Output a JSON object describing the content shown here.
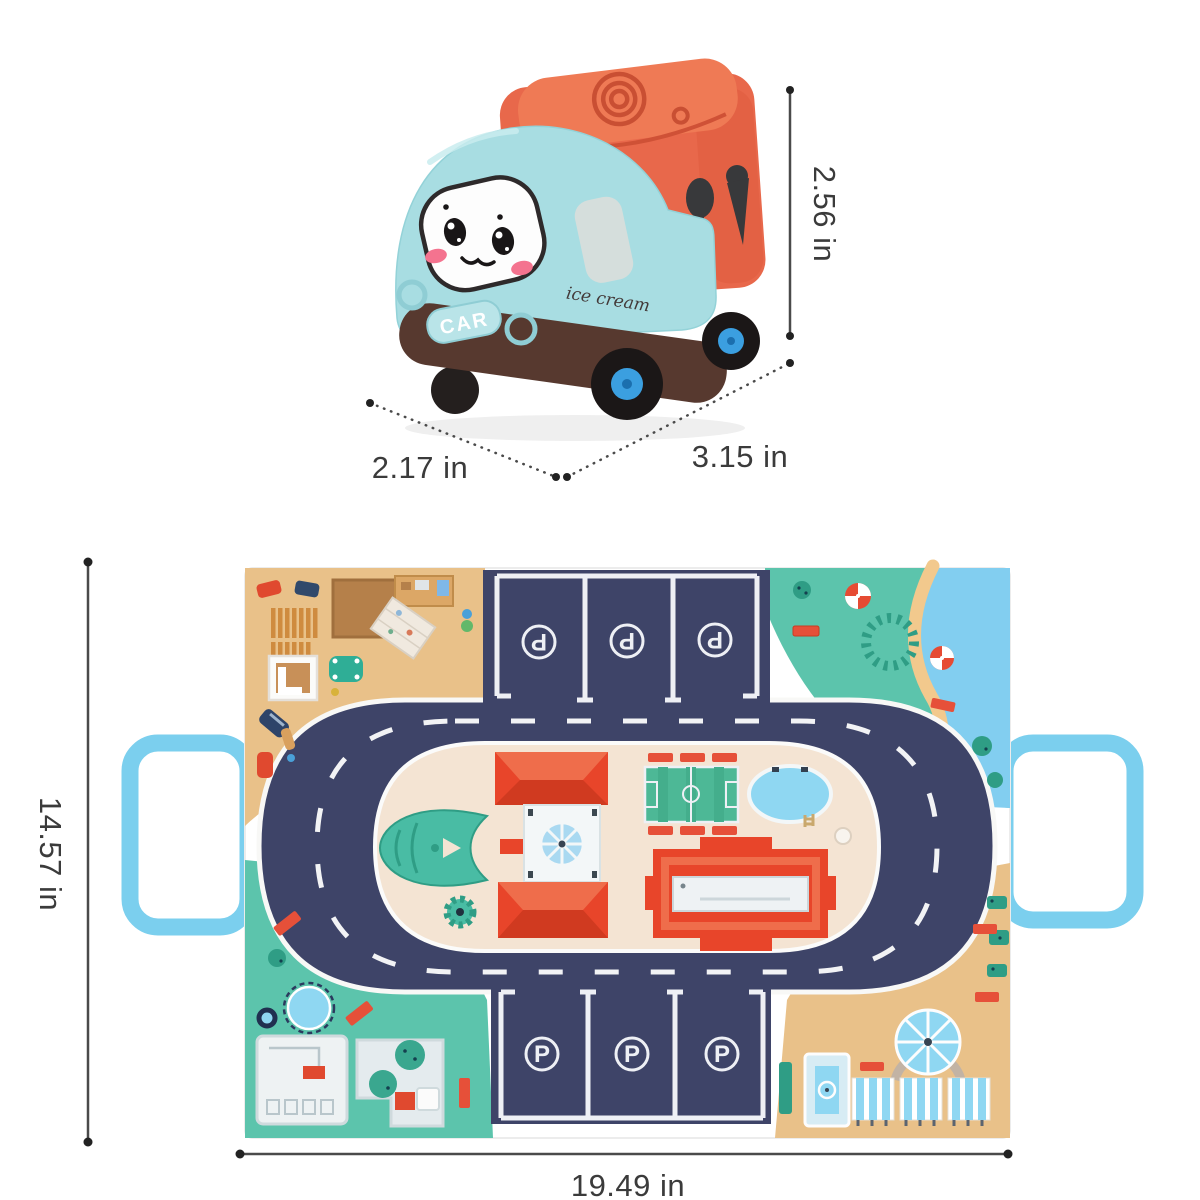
{
  "product": {
    "car": {
      "plate_label": "CAR",
      "side_label": "ice cream"
    },
    "mat": {
      "parking_letter": "P"
    }
  },
  "dimensions": {
    "car_height": "2.56 in",
    "car_width": "2.17 in",
    "car_length": "3.15 in",
    "mat_height": "14.57 in",
    "mat_width": "19.49 in"
  },
  "colors": {
    "car_body": "#a8dde2",
    "car_roof": "#e8684b",
    "car_chassis": "#57392f",
    "wheel_hub": "#3b9fe0",
    "blush_pink": "#f4738f",
    "road_navy": "#3e4468",
    "mat_sand": "#e9c189",
    "mat_grass": "#5cc4ac",
    "water_blue": "#82cef0",
    "island_cream": "#f4e4d3",
    "building_red": "#e8452a",
    "pool_blue": "#8fd7f2",
    "handle_blue": "#7bcfee",
    "marking_white": "#eef0f5",
    "dimension_line": "#4a4a4a",
    "dimension_text": "#3b3b3b"
  }
}
